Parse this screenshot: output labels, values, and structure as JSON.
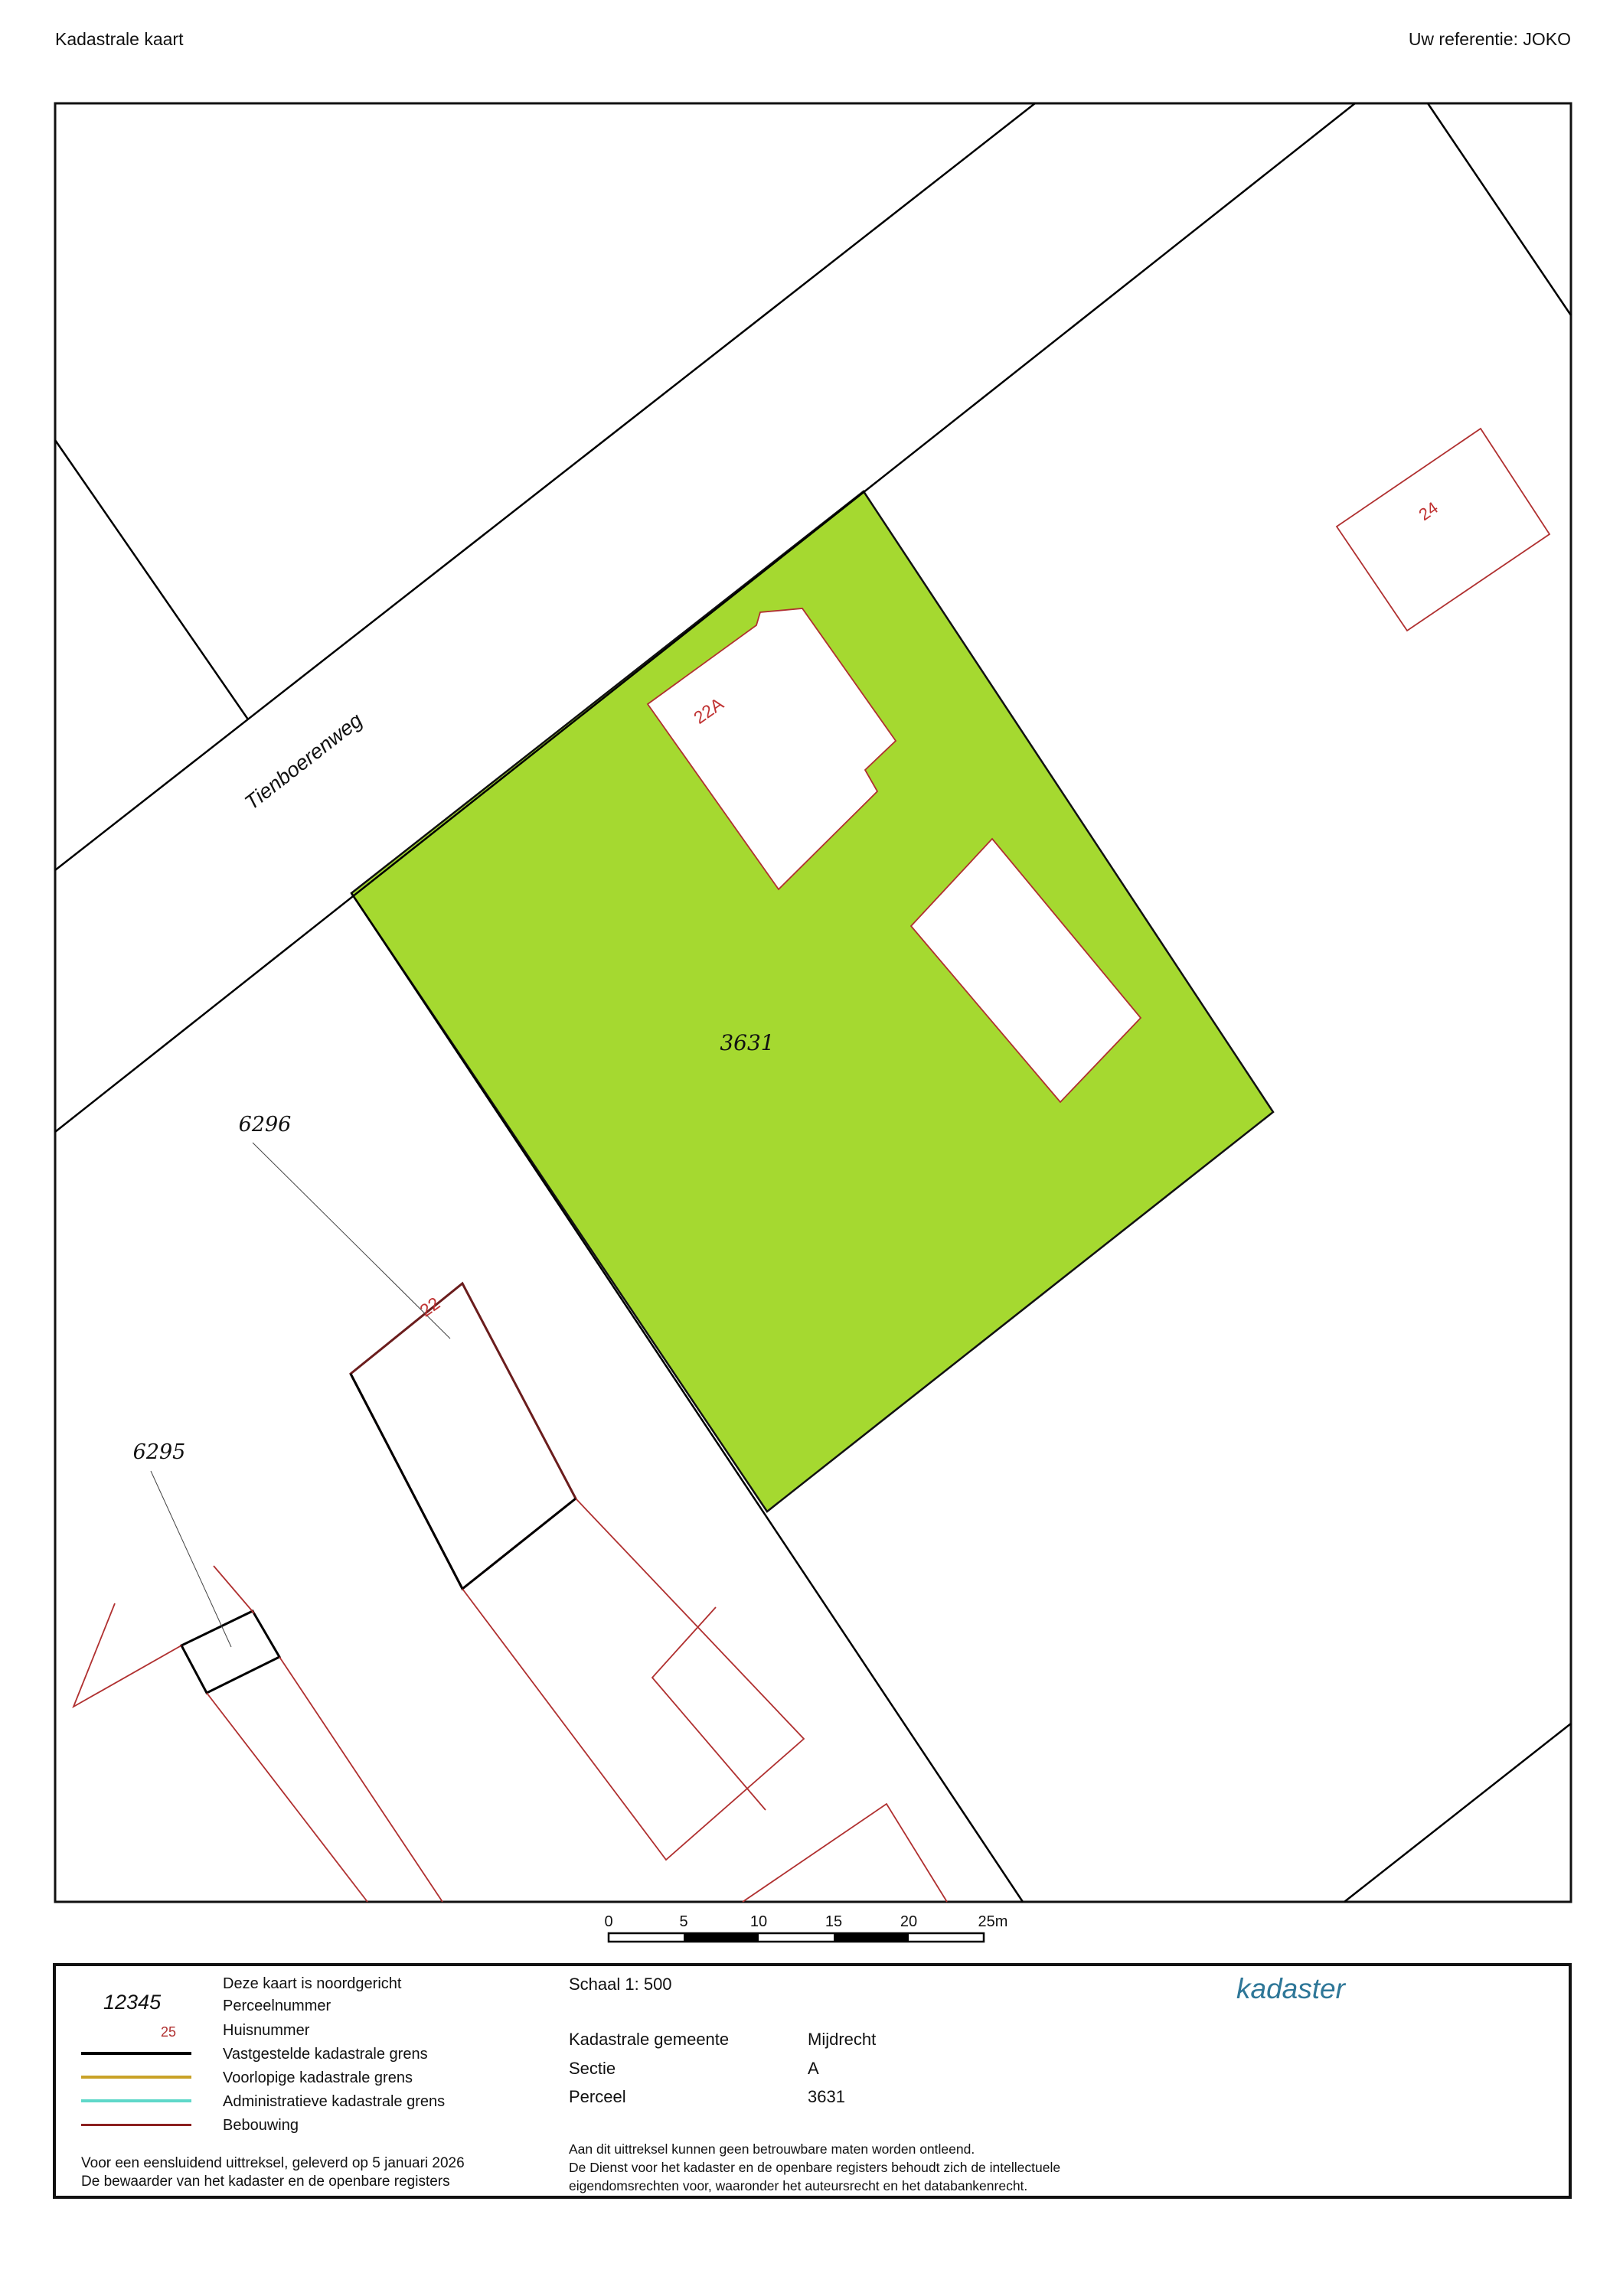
{
  "header": {
    "title": "Kadastrale kaart",
    "reference": "Uw referentie: JOKO"
  },
  "map": {
    "road_name": "Tienboerenweg",
    "selected_parcel_number": "3631",
    "parcel_numbers": {
      "p6296": "6296",
      "p6295": "6295"
    },
    "house_numbers": {
      "h22a": "22A",
      "h22": "22",
      "h24": "24"
    },
    "highlight_color": "#a5d930",
    "boundary_color": "#000000",
    "building_color": "#b03030"
  },
  "scale_bar": {
    "ticks": [
      "0",
      "5",
      "10",
      "15",
      "20",
      "25m"
    ]
  },
  "legend": {
    "north_note": "Deze kaart is noordgericht",
    "items": [
      {
        "sample": "12345",
        "label": "Perceelnummer"
      },
      {
        "sample": "25",
        "label": "Huisnummer"
      },
      {
        "label": "Vastgestelde kadastrale grens",
        "color": "#000000"
      },
      {
        "label": "Voorlopige kadastrale grens",
        "color": "#c9a227"
      },
      {
        "label": "Administratieve kadastrale grens",
        "color": "#5fd8c9"
      },
      {
        "label": "Bebouwing",
        "color": "#8b2020"
      }
    ],
    "footer_line1": "Voor een eensluidend uittreksel, geleverd op 5 januari 2026",
    "footer_line2": "De bewaarder van het kadaster en de openbare registers"
  },
  "details": {
    "scale_label": "Schaal 1: 500",
    "rows": [
      {
        "label": "Kadastrale gemeente",
        "value": "Mijdrecht"
      },
      {
        "label": "Sectie",
        "value": "A"
      },
      {
        "label": "Perceel",
        "value": "3631"
      }
    ],
    "disclaimer_line1": "Aan dit uittreksel kunnen geen betrouwbare maten worden ontleend.",
    "disclaimer_line2": "De Dienst voor het kadaster en de openbare registers behoudt zich de intellectuele",
    "disclaimer_line3": "eigendomsrechten voor, waaronder het auteursrecht en het databankenrecht."
  },
  "logo": {
    "text": "kadaster",
    "light_color": "#4387a9",
    "dark_color": "#32326b"
  }
}
